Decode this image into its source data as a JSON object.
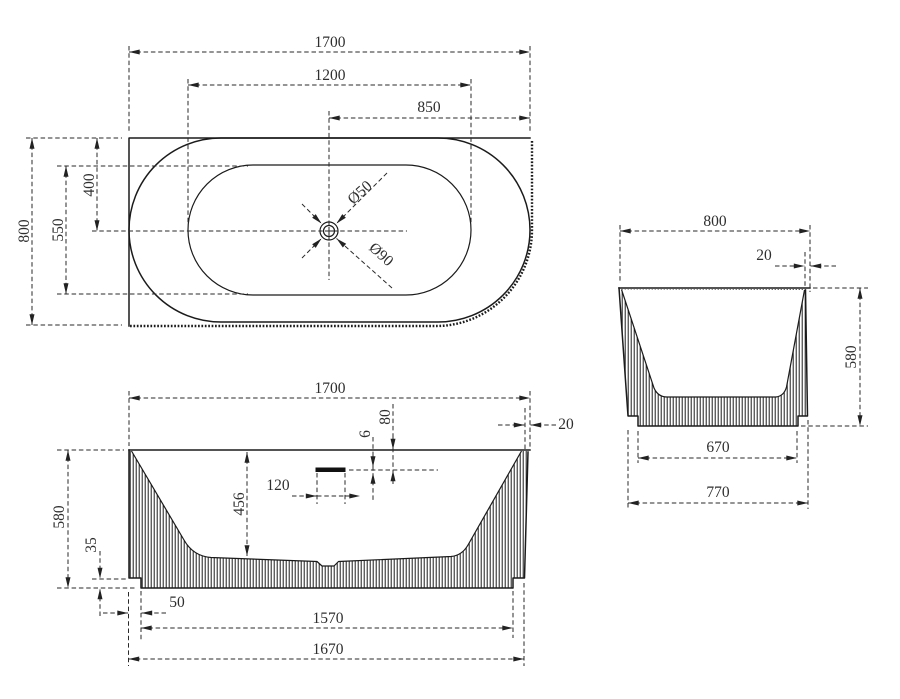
{
  "drawing": {
    "top_view": {
      "length_overall": "1700",
      "length_inner": "1200",
      "drain_to_end": "850",
      "width_overall": "800",
      "width_inner": "550",
      "drain_to_back": "400",
      "drain_diameter": "Ø50",
      "waste_diameter": "Ø90"
    },
    "front_view": {
      "length_overall": "1700",
      "rim_lip": "20",
      "overflow_drop": "80",
      "overflow_slot": "6",
      "overflow_length": "120",
      "inner_depth": "456",
      "height_overall": "580",
      "base_recess": "35",
      "base_inset": "50",
      "base_length": "1570",
      "shell_length": "1670"
    },
    "side_view": {
      "width_overall": "800",
      "rim_lip": "20",
      "height_overall": "580",
      "base_width": "670",
      "shell_width": "770"
    }
  }
}
